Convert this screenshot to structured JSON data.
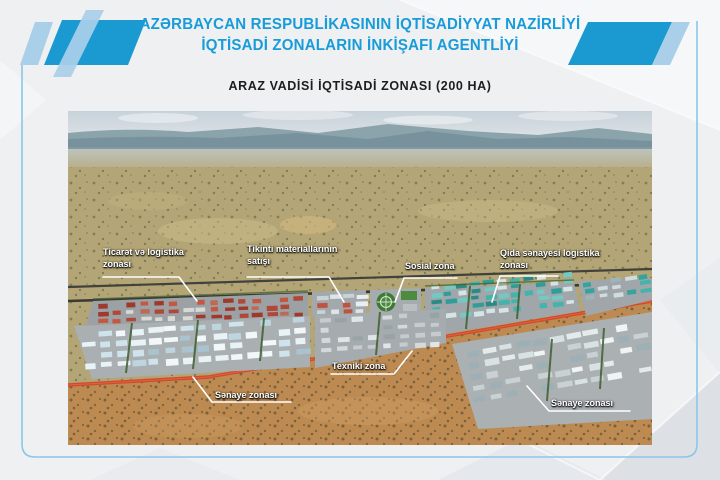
{
  "header": {
    "line1": "AZƏRBAYCAN RESPUBLİKASININ İQTİSADİYYAT NAZİRLİYİ",
    "line2": "İQTİSADİ ZONALARIN İNKİŞAFI AGENTLİYİ"
  },
  "slide_title": "ARAZ VADİSİ İQTİSADİ ZONASI (200 HA)",
  "map": {
    "labels": {
      "trade_logistics": "Ticarət və logistika zonası",
      "construction_materials": "Tikinti materiallarının satışı",
      "social": "Sosial zona",
      "food_logistics": "Qida sənayesi logistika zonası",
      "technical": "Texniki zona",
      "industrial_left": "Sənaye zonası",
      "industrial_right": "Sənaye zonası"
    }
  },
  "colors": {
    "accent_blue": "#189cd9",
    "light_blue": "#a9cfe9",
    "frame_blue": "#8cc6e8",
    "title_text": "#1d1d1f",
    "road_red": "#d14a2b"
  }
}
